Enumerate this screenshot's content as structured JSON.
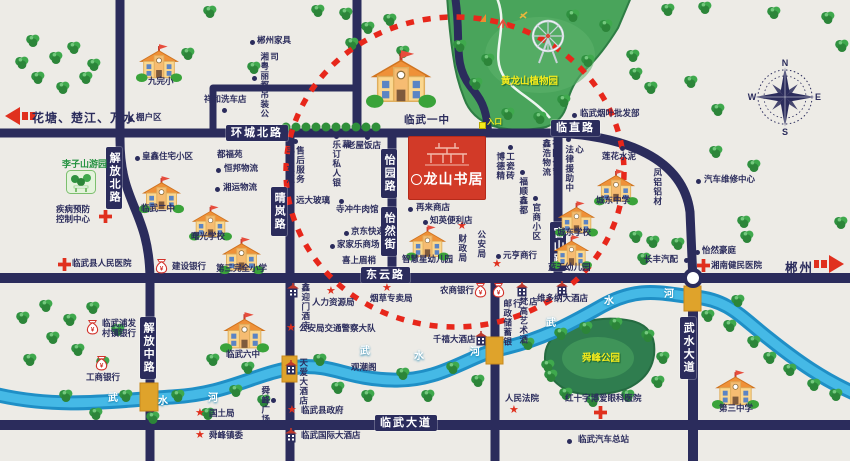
{
  "logo": {
    "name": "龙山书居"
  },
  "legend": {
    "left_arrow": "花塘、楚江、万水",
    "right_arrow": "郴州"
  },
  "compass": {
    "n": "N",
    "e": "E",
    "s": "S",
    "w": "W"
  },
  "parks": {
    "botanic": "黄龙山植物园",
    "entrance": "入口",
    "shunfeng": "舜峰公园",
    "lizishan": "李子山游园"
  },
  "road_labels": [
    {
      "t": "环城北路",
      "x": 226,
      "y": 125
    },
    {
      "t": "临直路",
      "x": 551,
      "y": 120
    },
    {
      "t": "东云路",
      "x": 361,
      "y": 267
    },
    {
      "t": "临武大道",
      "x": 375,
      "y": 415
    },
    {
      "t": "解放北路",
      "x": 106,
      "y": 147,
      "v": 1
    },
    {
      "t": "晴岚路",
      "x": 271,
      "y": 187,
      "v": 1
    },
    {
      "t": "怡园路",
      "x": 381,
      "y": 149,
      "v": 1
    },
    {
      "t": "怡然街",
      "x": 381,
      "y": 207,
      "v": 1
    },
    {
      "t": "官山路",
      "x": 550,
      "y": 222,
      "v": 1
    },
    {
      "t": "解放中路",
      "x": 140,
      "y": 317,
      "v": 1
    },
    {
      "t": "武水大道",
      "x": 680,
      "y": 317,
      "v": 1
    }
  ],
  "river": {
    "sets": [
      {
        "chars": [
          "武",
          "水",
          "河"
        ],
        "pts": [
          [
            108,
            393
          ],
          [
            158,
            396
          ],
          [
            208,
            393
          ]
        ]
      },
      {
        "chars": [
          "武",
          "水",
          "河"
        ],
        "pts": [
          [
            360,
            346
          ],
          [
            414,
            351
          ],
          [
            470,
            347
          ]
        ]
      },
      {
        "chars": [
          "武",
          "水",
          "河"
        ],
        "pts": [
          [
            546,
            318
          ],
          [
            604,
            296
          ],
          [
            664,
            289
          ]
        ]
      }
    ]
  },
  "places": [
    {
      "t": "九完小",
      "x": 148,
      "y": 77,
      "icon": "school",
      "ix": 136,
      "iy": 44,
      "isz": 46
    },
    {
      "t": "临武一中",
      "x": 404,
      "y": 114,
      "big": 1,
      "icon": "school",
      "ix": 366,
      "iy": 50,
      "isz": 70
    },
    {
      "t": "临武二中",
      "x": 141,
      "y": 204,
      "icon": "school",
      "ix": 139,
      "iy": 176,
      "isz": 45
    },
    {
      "t": "曙光学校",
      "x": 191,
      "y": 232,
      "icon": "school",
      "ix": 189,
      "iy": 205,
      "isz": 43
    },
    {
      "t": "第三完全小学",
      "x": 216,
      "y": 264,
      "icon": "school",
      "ix": 219,
      "iy": 237,
      "isz": 45
    },
    {
      "t": "智慧星幼儿园",
      "x": 402,
      "y": 255,
      "icon": "school",
      "ix": 406,
      "iy": 225,
      "isz": 43
    },
    {
      "t": "城东中学",
      "x": 596,
      "y": 196,
      "icon": "school",
      "ix": 594,
      "iy": 169,
      "isz": 44
    },
    {
      "t": "城东学校",
      "x": 557,
      "y": 228,
      "icon": "school",
      "ix": 555,
      "iy": 201,
      "isz": 43
    },
    {
      "t": "蓝天幼儿园",
      "x": 548,
      "y": 263,
      "icon": "school",
      "ix": 551,
      "iy": 235,
      "isz": 41
    },
    {
      "t": "临武六中",
      "x": 226,
      "y": 350,
      "icon": "school",
      "ix": 220,
      "iy": 312,
      "isz": 49
    },
    {
      "t": "第三中学",
      "x": 719,
      "y": 404,
      "icon": "school",
      "ix": 712,
      "iy": 370,
      "isz": 47
    },
    {
      "t": "疾病预防\n控制中心",
      "x": 56,
      "y": 205,
      "icon": "cross",
      "ix": 99,
      "iy": 210
    },
    {
      "t": "临武县人民医院",
      "x": 72,
      "y": 259,
      "icon": "cross",
      "ix": 58,
      "iy": 258
    },
    {
      "t": "湘南健民医院",
      "x": 711,
      "y": 261,
      "icon": "cross",
      "ix": 697,
      "iy": 259
    },
    {
      "t": "红十字博爱眼科医院",
      "x": 565,
      "y": 394,
      "icon": "cross",
      "ix": 594,
      "iy": 406
    },
    {
      "t": "建设银行",
      "x": 172,
      "y": 262,
      "icon": "bag",
      "ix": 155,
      "iy": 258
    },
    {
      "t": "工商银行",
      "x": 86,
      "y": 373,
      "icon": "bag",
      "ix": 95,
      "iy": 355
    },
    {
      "t": "临武浦发\n村镇银行",
      "x": 102,
      "y": 319,
      "icon": "bag",
      "ix": 86,
      "iy": 319
    },
    {
      "t": "农商银行",
      "x": 440,
      "y": 286,
      "icon": "bag",
      "ix": 474,
      "iy": 282
    },
    {
      "t": "邮政储蓄银行",
      "x": 502,
      "y": 299,
      "v": 1,
      "h": 56,
      "icon": "bag",
      "ix": 492,
      "iy": 282
    },
    {
      "t": "鑫迎门酒店",
      "x": 300,
      "y": 283,
      "v": 1,
      "h": 48,
      "icon": "hotel",
      "ix": 287,
      "iy": 283
    },
    {
      "t": "天爱大酒店",
      "x": 298,
      "y": 358,
      "v": 1,
      "h": 48,
      "icon": "hotel",
      "ix": 285,
      "iy": 360
    },
    {
      "t": "千禧大酒店",
      "x": 433,
      "y": 335,
      "icon": "hotel",
      "ix": 475,
      "iy": 331
    },
    {
      "t": "维多纳大酒店",
      "x": 537,
      "y": 294,
      "icon": "hotel",
      "ix": 556,
      "iy": 281
    },
    {
      "t": "梵高艺术酒店",
      "x": 518,
      "y": 297,
      "v": 1,
      "h": 56,
      "icon": "hotel",
      "ix": 516,
      "iy": 282
    },
    {
      "t": "临武国际大酒店",
      "x": 301,
      "y": 431,
      "icon": "hotel",
      "ix": 285,
      "iy": 428
    },
    {
      "t": "财政局",
      "x": 457,
      "y": 234,
      "v": 1,
      "h": 30,
      "icon": "star",
      "ix": 457,
      "iy": 221
    },
    {
      "t": "公安局",
      "x": 476,
      "y": 230,
      "v": 1,
      "h": 30,
      "icon": "star",
      "ix": 492,
      "iy": 259
    },
    {
      "t": "人力资源局",
      "x": 312,
      "y": 298,
      "icon": "star",
      "ix": 326,
      "iy": 286
    },
    {
      "t": "烟草专卖局",
      "x": 370,
      "y": 294,
      "icon": "star",
      "ix": 382,
      "iy": 283
    },
    {
      "t": "公安局交通警察大队",
      "x": 299,
      "y": 324,
      "icon": "star",
      "ix": 286,
      "iy": 323
    },
    {
      "t": "国土局",
      "x": 209,
      "y": 409,
      "icon": "star",
      "ix": 195,
      "iy": 408
    },
    {
      "t": "舜峰镇委",
      "x": 209,
      "y": 431,
      "icon": "star",
      "ix": 195,
      "iy": 430
    },
    {
      "t": "临武县政府",
      "x": 301,
      "y": 406,
      "icon": "star",
      "ix": 287,
      "iy": 405
    },
    {
      "t": "人民法院",
      "x": 505,
      "y": 394,
      "icon": "star",
      "ix": 509,
      "iy": 405
    },
    {
      "t": "郴州家具",
      "x": 257,
      "y": 36,
      "icon": "dot",
      "ix": 250,
      "iy": 40
    },
    {
      "t": "湘粤丽都吊装公司",
      "x": 259,
      "y": 52,
      "v": 1,
      "h": 72,
      "icon": "dot",
      "ix": 252,
      "iy": 76
    },
    {
      "t": "祥和洗车店",
      "x": 204,
      "y": 95,
      "icon": "dot",
      "ix": 222,
      "iy": 108
    },
    {
      "t": "棚户区",
      "x": 136,
      "y": 113,
      "icon": "dot",
      "ix": 128,
      "iy": 117
    },
    {
      "t": "皇鑫住宅小区",
      "x": 142,
      "y": 152,
      "icon": "dot",
      "ix": 135,
      "iy": 156
    },
    {
      "t": "都福苑",
      "x": 217,
      "y": 150
    },
    {
      "t": "恒邦物流",
      "x": 224,
      "y": 164,
      "icon": "dot",
      "ix": 216,
      "iy": 168
    },
    {
      "t": "湘运物流",
      "x": 223,
      "y": 183,
      "icon": "dot",
      "ix": 215,
      "iy": 187
    },
    {
      "t": "丰名车汇售后服务",
      "x": 285,
      "y": 146,
      "v": 1,
      "h": 40,
      "icon": "dot",
      "ix": 293,
      "iy": 139
    },
    {
      "t": "乐订私人银幕",
      "x": 331,
      "y": 140,
      "v": 1,
      "h": 56,
      "icon": "dot",
      "ix": 334,
      "iy": 134
    },
    {
      "t": "老屋饭店",
      "x": 347,
      "y": 141,
      "icon": "dot",
      "ix": 365,
      "iy": 135
    },
    {
      "t": "远大玻璃",
      "x": 296,
      "y": 196,
      "icon": "dot",
      "ix": 339,
      "iy": 199
    },
    {
      "t": "寺冲牛肉馆",
      "x": 336,
      "y": 205,
      "icon": "dot",
      "ix": 392,
      "iy": 208
    },
    {
      "t": "京东快递",
      "x": 351,
      "y": 227,
      "icon": "dot",
      "ix": 344,
      "iy": 231
    },
    {
      "t": "家家乐商场",
      "x": 337,
      "y": 240,
      "icon": "dot",
      "ix": 330,
      "iy": 244
    },
    {
      "t": "喜上眉梢",
      "x": 342,
      "y": 256
    },
    {
      "t": "再来商店",
      "x": 416,
      "y": 203,
      "icon": "dot",
      "ix": 408,
      "iy": 207
    },
    {
      "t": "知英便利店",
      "x": 430,
      "y": 216,
      "icon": "dot",
      "ix": 423,
      "iy": 220
    },
    {
      "t": "元亨商行",
      "x": 503,
      "y": 251,
      "icon": "dot",
      "ix": 496,
      "iy": 254
    },
    {
      "t": "博德精工瓷砖",
      "x": 495,
      "y": 152,
      "v": 1,
      "h": 30,
      "icon": "dot",
      "ix": 508,
      "iy": 145
    },
    {
      "t": "福顺鑫都",
      "x": 518,
      "y": 177,
      "v": 1,
      "h": 38,
      "icon": "dot",
      "ix": 520,
      "iy": 170
    },
    {
      "t": "官商小区",
      "x": 531,
      "y": 203,
      "v": 1,
      "h": 38,
      "icon": "dot",
      "ix": 533,
      "iy": 196
    },
    {
      "t": "鑫浩物流有限公司",
      "x": 541,
      "y": 139,
      "v": 1,
      "h": 38
    },
    {
      "t": "临武烟叶批发部",
      "x": 580,
      "y": 109,
      "icon": "dot",
      "ix": 572,
      "iy": 113
    },
    {
      "t": "法律援助中心",
      "x": 564,
      "y": 145,
      "v": 1,
      "h": 54,
      "icon": "dot",
      "ix": 566,
      "iy": 137
    },
    {
      "t": "莲花水泥",
      "x": 602,
      "y": 152,
      "icon": "dot",
      "ix": 620,
      "iy": 146
    },
    {
      "t": "凤铝铝材",
      "x": 652,
      "y": 168,
      "v": 1,
      "h": 38,
      "icon": "dot",
      "ix": 660,
      "iy": 163
    },
    {
      "t": "汽车维修中心",
      "x": 704,
      "y": 175,
      "icon": "dot",
      "ix": 696,
      "iy": 179
    },
    {
      "t": "怡然豪庭",
      "x": 702,
      "y": 246,
      "icon": "dot",
      "ix": 695,
      "iy": 250
    },
    {
      "t": "长丰汽配",
      "x": 644,
      "y": 255,
      "icon": "dot",
      "ix": 684,
      "iy": 258
    },
    {
      "t": "临武汽车总站",
      "x": 578,
      "y": 435,
      "icon": "dot",
      "ix": 567,
      "iy": 439
    },
    {
      "t": "舜峰广场",
      "x": 260,
      "y": 386,
      "v": 1,
      "h": 38,
      "icon": "dot",
      "ix": 271,
      "iy": 398
    },
    {
      "t": "观潮阁",
      "x": 351,
      "y": 363
    },
    {
      "t": "李子山游园",
      "x": 62,
      "y": 159,
      "cls": "green",
      "icon": "park",
      "ix": 66,
      "iy": 170
    },
    {
      "t": "黄龙山植物园",
      "x": 501,
      "y": 77,
      "cls": "yellow"
    },
    {
      "t": "入口",
      "x": 487,
      "y": 118,
      "cls": "yellow-sm",
      "icon": "ydot",
      "ix": 479,
      "iy": 122
    },
    {
      "t": "舜峰公园",
      "x": 582,
      "y": 354,
      "cls": "yellow"
    }
  ]
}
